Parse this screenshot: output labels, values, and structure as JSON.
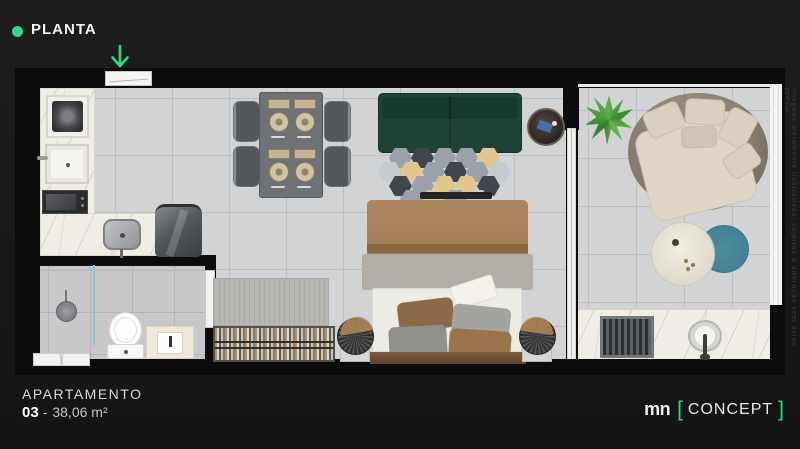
{
  "header": {
    "title": "PLANTA"
  },
  "icons": {
    "bullet": "green-circle",
    "entry_arrow": "arrow-down"
  },
  "apartment": {
    "label": "APARTAMENTO",
    "number": "03",
    "separator": "-",
    "area": "38,06 m²"
  },
  "brand": {
    "logo": "mn",
    "bracket_open": "[",
    "name": "CONCEPT",
    "bracket_close": "]"
  },
  "watermark": "Imagens meramente ilustrativas, sujeitas a alteração sem aviso prévio.",
  "colors": {
    "accent": "#31d687",
    "page_bg": "#1a1a1a",
    "wall": "#0c0c0c",
    "floor": "#d2d3d5",
    "floor_line": "#bdbec0",
    "bath_floor": "#c7c8ca",
    "marble": "#efede6",
    "sofa_green": "#1e4236",
    "bed_tan": "#a5805c",
    "bed_throw": "#b2aea5",
    "balcony_teal": "#4d8d9e",
    "rattan": "#7c7164",
    "plant_green": "#4c9a3c",
    "text_primary": "#f2f2f2",
    "text_secondary": "#c4c4c4"
  }
}
